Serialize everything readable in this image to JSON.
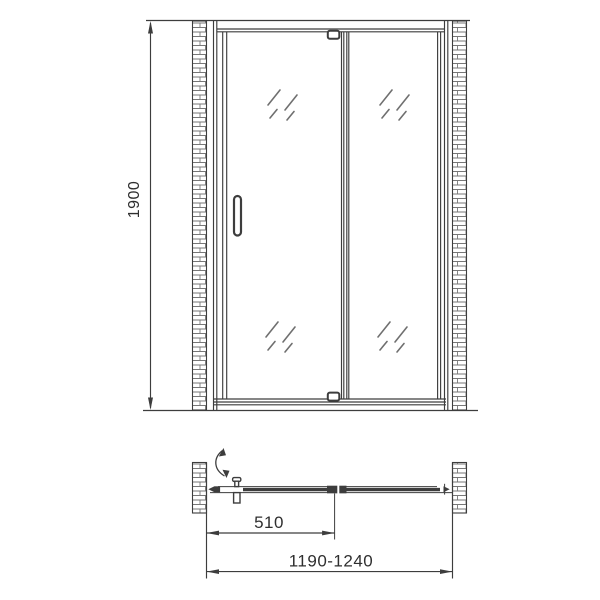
{
  "colors": {
    "line": "#3d3d3d",
    "brick": "#777777",
    "hatch": "#6f6f6f",
    "text": "#2f2f2f",
    "background": "#ffffff"
  },
  "front_view": {
    "height_label": "1900"
  },
  "plan_view": {
    "door_width_label": "510",
    "overall_width_label": "1190-1240"
  }
}
